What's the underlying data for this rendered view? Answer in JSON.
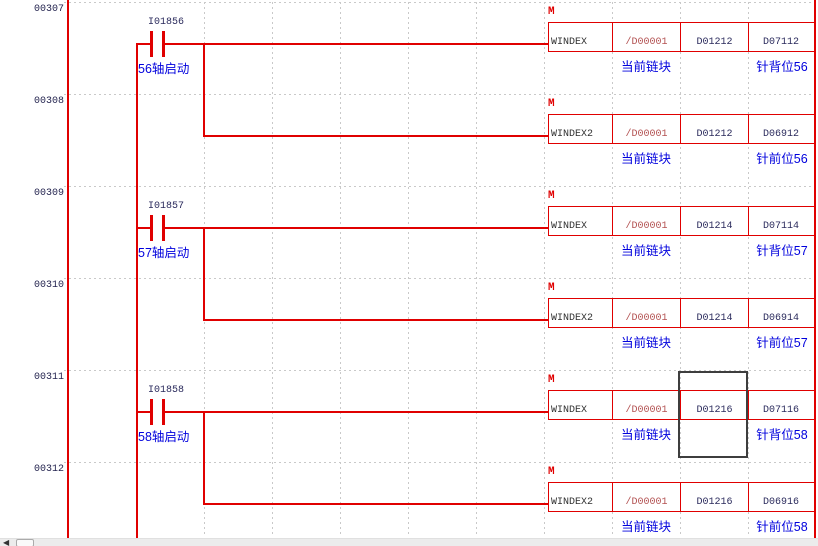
{
  "colors": {
    "wire": "#e00000",
    "grid": "#c9c9c9",
    "register_text": "#2a2a5c",
    "instruction_text": "#303030",
    "inverted_operand_text": "#b25050",
    "comment_text": "#0000dd",
    "rung_number_text": "#23234f",
    "selection_border": "#3e3e3e"
  },
  "rungs": [
    {
      "number": "00307",
      "contact": {
        "name": "I01856",
        "comment": "56轴启动"
      },
      "block": {
        "marker": "M",
        "instruction": "WINDEX",
        "operands": [
          "/D00001",
          "D01212",
          "D07112"
        ],
        "comments": [
          "当前链块",
          "针背位56"
        ]
      }
    },
    {
      "number": "00308",
      "block": {
        "marker": "M",
        "instruction": "WINDEX2",
        "operands": [
          "/D00001",
          "D01212",
          "D06912"
        ],
        "comments": [
          "当前链块",
          "针前位56"
        ]
      }
    },
    {
      "number": "00309",
      "contact": {
        "name": "I01857",
        "comment": "57轴启动"
      },
      "block": {
        "marker": "M",
        "instruction": "WINDEX",
        "operands": [
          "/D00001",
          "D01214",
          "D07114"
        ],
        "comments": [
          "当前链块",
          "针背位57"
        ]
      }
    },
    {
      "number": "00310",
      "block": {
        "marker": "M",
        "instruction": "WINDEX2",
        "operands": [
          "/D00001",
          "D01214",
          "D06914"
        ],
        "comments": [
          "当前链块",
          "针前位57"
        ]
      }
    },
    {
      "number": "00311",
      "contact": {
        "name": "I01858",
        "comment": "58轴启动"
      },
      "block": {
        "marker": "M",
        "instruction": "WINDEX",
        "operands": [
          "/D00001",
          "D01216",
          "D07116"
        ],
        "comments": [
          "当前链块",
          "针背位58"
        ]
      }
    },
    {
      "number": "00312",
      "block": {
        "marker": "M",
        "instruction": "WINDEX2",
        "operands": [
          "/D00001",
          "D01216",
          "D06916"
        ],
        "comments": [
          "当前链块",
          "针前位58"
        ]
      }
    }
  ],
  "selection": {
    "rung": "00311",
    "operand": "D01216"
  },
  "scrollbar": {
    "left_arrow": "◀"
  }
}
